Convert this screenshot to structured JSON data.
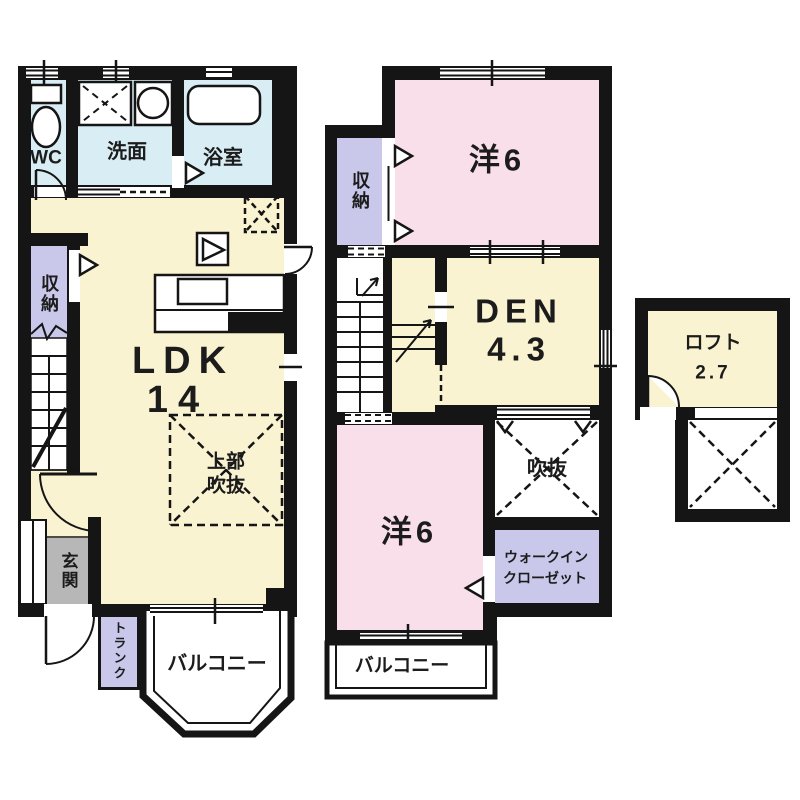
{
  "floor1": {
    "wc": "WC",
    "washroom": "洗面",
    "bathroom": "浴室",
    "storage": "収納",
    "ldk": "LDK",
    "ldk_size": "14",
    "void_upper_line1": "上部",
    "void_upper_line2": "吹抜",
    "entrance": "玄関",
    "trunk": "トランク",
    "balcony": "バルコニー"
  },
  "floor2": {
    "storage": "収納",
    "western_room_top": "洋6",
    "den": "DEN",
    "den_size": "4.3",
    "void": "吹抜",
    "western_room_bottom": "洋6",
    "wic_line1": "ウォークイン",
    "wic_line2": "クローゼット",
    "balcony": "バルコニー"
  },
  "loft": {
    "label": "ロフト",
    "size": "2.7"
  },
  "colors": {
    "wall": "#151515",
    "room_yellow": "#faf3d2",
    "room_pink": "#f9dfe9",
    "room_blue": "#d9edf5",
    "room_purple": "#c9c7ea",
    "entrance_gray": "#b7b7b7"
  }
}
